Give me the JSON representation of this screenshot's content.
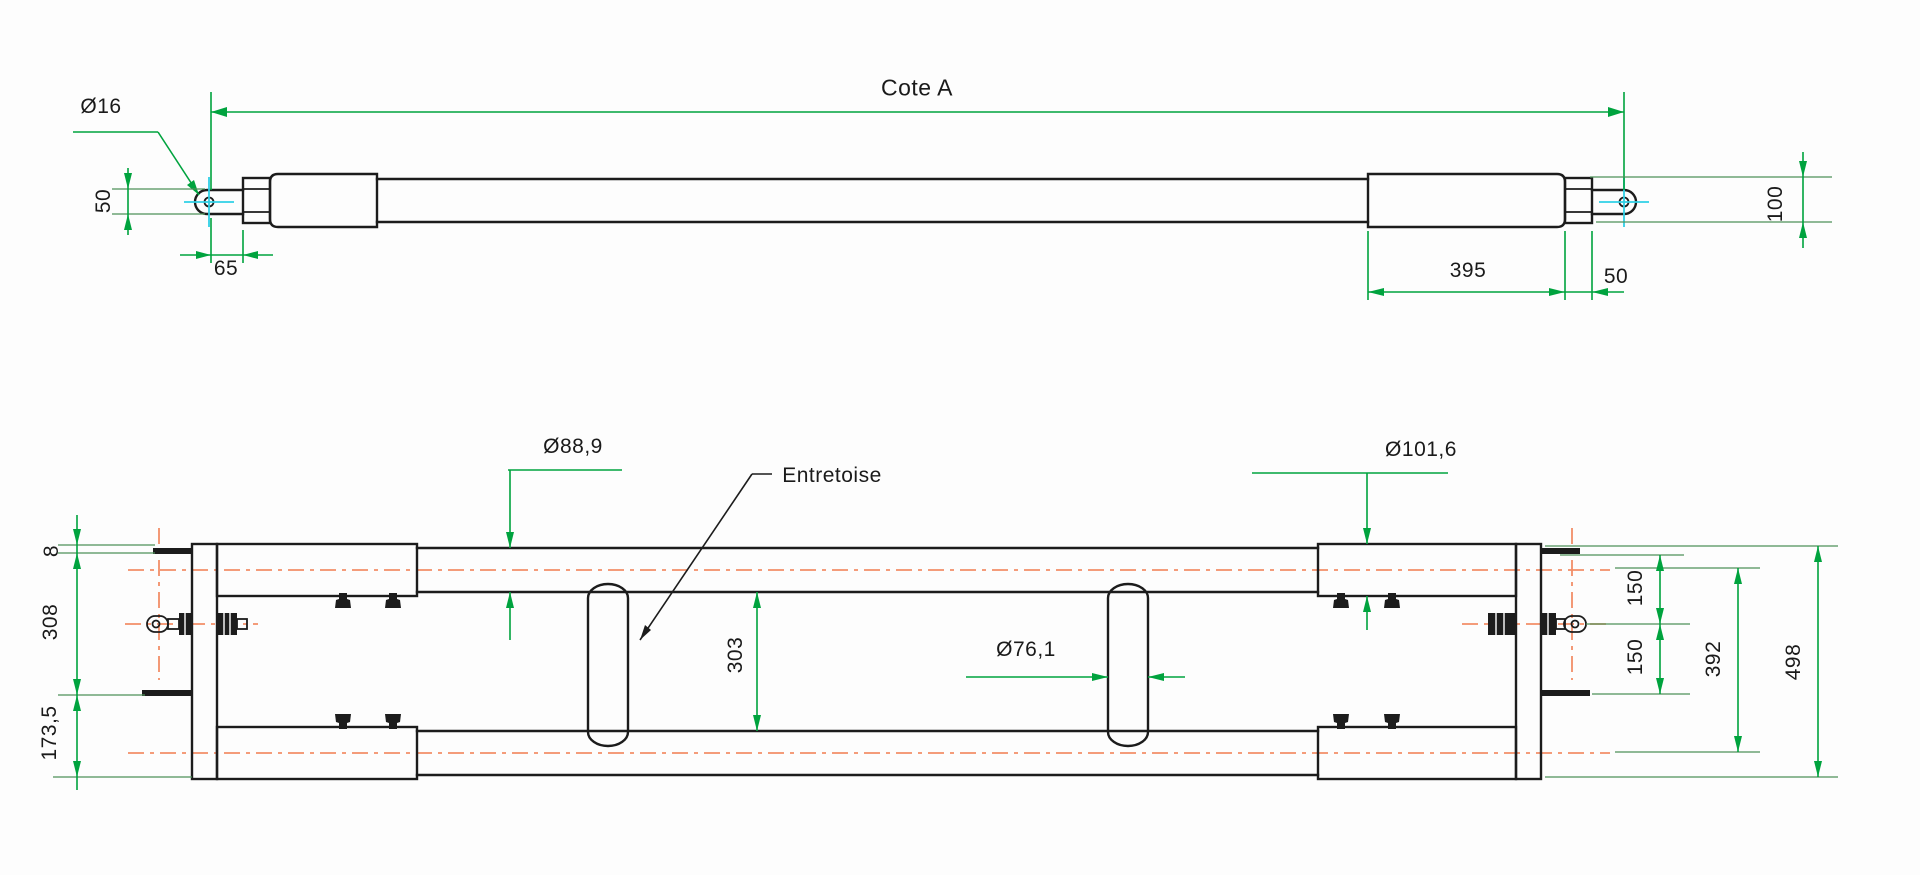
{
  "drawing": {
    "type": "technical-drawing",
    "views": {
      "top": {
        "dimensions": {
          "overall_length": "Cote A",
          "pin_hole_diameter": "Ø16",
          "eye_plate_height": "50",
          "eye_to_body_offset": "65",
          "sleeve_length": "395",
          "nut_width": "50",
          "end_outer_height": "100"
        }
      },
      "bottom": {
        "labels": {
          "spacer_callout": "Entretoise"
        },
        "dimensions": {
          "tube_outer_diameter": "Ø88,9",
          "sleeve_outer_diameter": "Ø101,6",
          "spacer_tube_diameter": "Ø76,1",
          "tube_inner_gap": "303",
          "tab_thickness": "8",
          "tab_to_tab_height": "308",
          "tab_to_bottom_height": "173,5",
          "eyebolt_offset_upper": "150",
          "eyebolt_offset_lower": "150",
          "tube_centers_distance": "392",
          "overall_height": "498"
        }
      }
    },
    "colors": {
      "dimension_green": "#00a33e",
      "centerline_orange": "#f28e68",
      "outline_black": "#1c1c1c",
      "axis_cyan": "#2fd0e6"
    }
  }
}
